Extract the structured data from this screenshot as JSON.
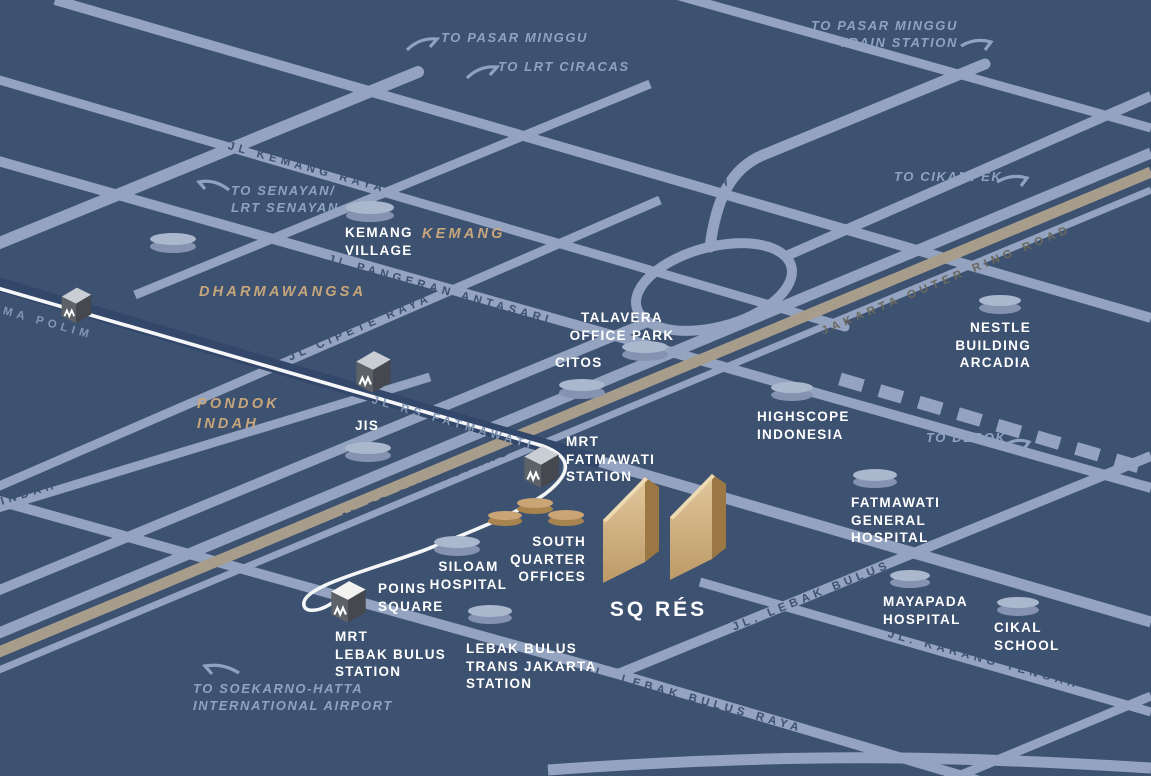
{
  "title": "SQ RÉS location map",
  "colors": {
    "background": "#3d5170",
    "road": "#93a3c0",
    "road_shadow": "#33476a",
    "toll_road": "#a89d8b",
    "mrt_line": "#f5f6f8",
    "landmark_top": "#aab7cd",
    "landmark_side": "#8593b0",
    "tan_landmark_top": "#c9a474",
    "tan_landmark_side": "#a7834e",
    "tower_light": "#e2c79c",
    "tower_dark": "#9a7743",
    "label_white": "#ffffff",
    "label_area": "#c7a67c",
    "label_direction": "#8fa2c2",
    "mrt_cube": "#5d6269"
  },
  "landmarks": {
    "kemang_village": "KEMANG\nVILLAGE",
    "talavera": "TALAVERA\nOFFICE PARK",
    "citos": "CITOS",
    "nestle": "NESTLE\nBUILDING\nARCADIA",
    "highscope": "HIGHSCOPE\nINDONESIA",
    "mrt_fatmawati": "MRT\nFATMAWATI\nSTATION",
    "fatmawati_general": "FATMAWATI\nGENERAL\nHOSPITAL",
    "south_quarter_offices": "SOUTH\nQUARTER\nOFFICES",
    "siloam": "SILOAM\nHOSPITAL",
    "poins_square": "POINS\nSQUARE",
    "mrt_lebak_bulus": "MRT\nLEBAK BULUS\nSTATION",
    "lebak_bulus_transjakarta": "LEBAK BULUS\nTRANS JAKARTA\nSTATION",
    "mayapada": "MAYAPADA\nHOSPITAL",
    "cikal": "CIKAL\nSCHOOL",
    "jis": "JIS",
    "sq_res": "SQ RÉS"
  },
  "areas": {
    "kemang": "KEMANG",
    "dharmawangsa": "DHARMAWANGSA",
    "pondok_indah": "PONDOK\nINDAH"
  },
  "directions": {
    "pasar_minggu": "TO PASAR MINGGU",
    "lrt_ciracas": "TO LRT CIRACAS",
    "pasar_minggu_train": "TO PASAR MINGGU\nTRAIN STATION",
    "senayan": "TO SENAYAN/\nLRT SENAYAN",
    "cikampek": "TO CIKAMPEK",
    "depok": "TO DEPOK",
    "airport": "TO SOEKARNO-HATTA\nINTERNATIONAL AIRPORT"
  },
  "roads": {
    "kemang_raya": "JL KEMANG RAYA",
    "ampera_raya": "JL AMPERA RAYA",
    "pangeran_antasari": "JL PANGERAN ANTASARI",
    "cipete_raya": "JL CIPETE RAYA",
    "rs_fatmawati": "JL RS FATMAWATI",
    "tb_simatupang": "JL TB SIMATUPANG",
    "outer_ring_road": "JAKARTA OUTER RING ROAD",
    "lebak_bulus": "JL. LEBAK BULUS",
    "karang_tengah": "JL. KARANG TENGAH",
    "lebak_bulus_raya": "JL. LEBAK BULUS RAYA",
    "panglima_polim_partial": "MA POLIM",
    "pondok_indah_partial": "INDAH"
  }
}
